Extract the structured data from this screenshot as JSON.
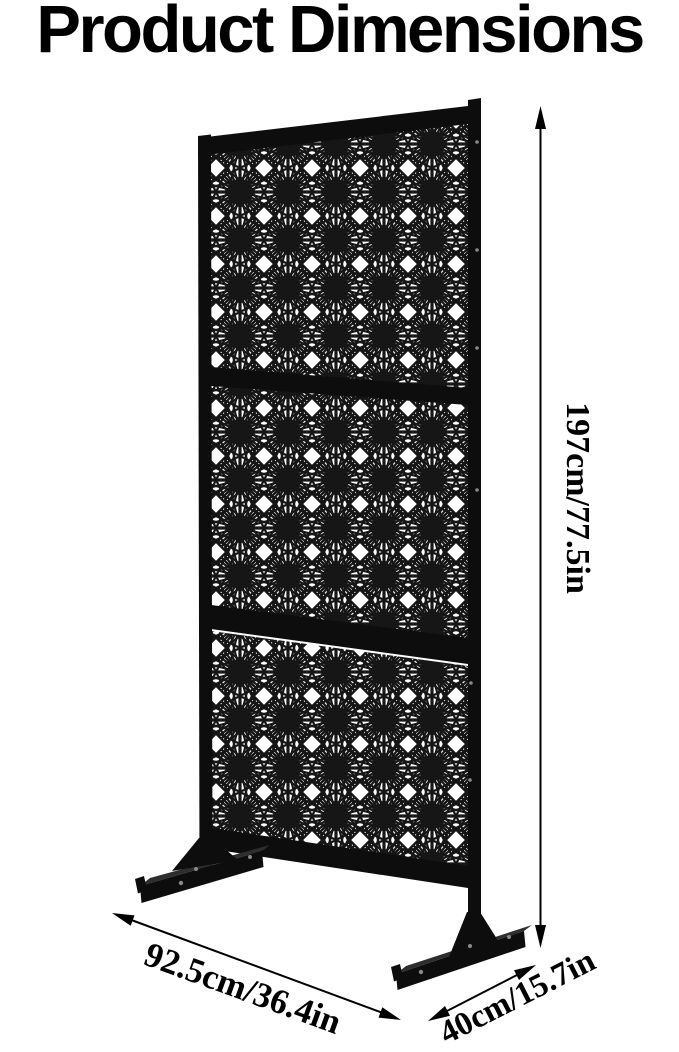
{
  "title": "Product Dimensions",
  "dimensions": {
    "height_label": "197cm/77.5in",
    "width_label": "92.5cm/36.4in",
    "depth_label": "40cm/15.7in"
  },
  "figure": {
    "panel_count": 3,
    "pattern_icon": "star-lattice-icon"
  },
  "colors": {
    "frame": "#0d0d0d",
    "pattern_line": "#161616",
    "background": "#ffffff",
    "text": "#000000",
    "metal_highlight": "#2e2e2e"
  }
}
